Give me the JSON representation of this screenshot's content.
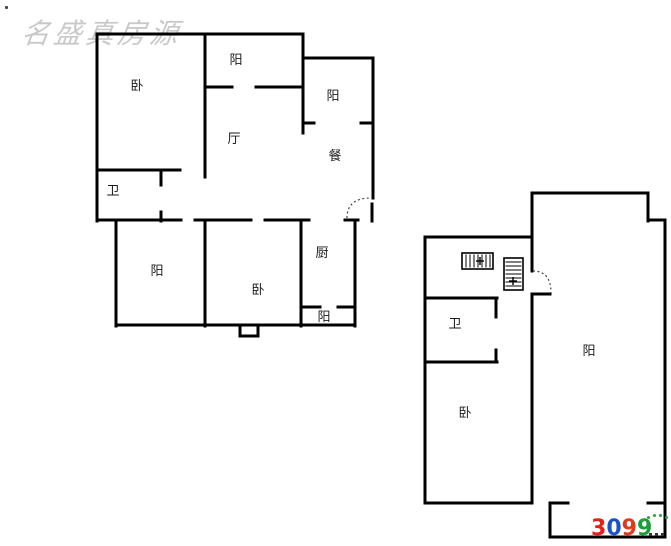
{
  "watermark": {
    "text": "名盛真房源",
    "color": "#c9c9c9"
  },
  "logo": {
    "digits": [
      {
        "char": "3",
        "color": "#e02316"
      },
      {
        "char": "0",
        "color": "#1c52c8"
      },
      {
        "char": "9",
        "color": "#e0391c"
      },
      {
        "char": "9",
        "color": "#1a9e36"
      }
    ],
    "arc_color": "#2f9e44",
    "arc_dot_count": 5,
    "tail_color": "#333333",
    "tail_mark_count": 3
  },
  "floorplans": [
    {
      "id": "unit-a",
      "walls": [
        [
          97,
          34,
          303,
          34
        ],
        [
          97,
          34,
          97,
          221
        ],
        [
          205,
          34,
          205,
          177
        ],
        [
          303,
          34,
          303,
          133
        ],
        [
          303,
          58,
          373,
          58
        ],
        [
          373,
          58,
          373,
          198
        ],
        [
          372,
          204,
          372,
          221
        ],
        [
          303,
          123,
          314,
          123
        ],
        [
          361,
          123,
          373,
          123
        ],
        [
          205,
          87,
          232,
          87
        ],
        [
          256,
          87,
          303,
          87
        ],
        [
          97,
          170,
          180,
          170
        ],
        [
          161,
          170,
          161,
          185
        ],
        [
          161,
          212,
          161,
          221
        ],
        [
          97,
          220,
          181,
          220
        ],
        [
          195,
          220,
          251,
          220
        ],
        [
          265,
          220,
          309,
          220
        ],
        [
          345,
          220,
          358,
          220
        ],
        [
          116,
          220,
          116,
          326
        ],
        [
          205,
          220,
          205,
          326
        ],
        [
          301,
          220,
          301,
          326
        ],
        [
          355,
          220,
          355,
          326
        ],
        [
          116,
          325,
          355,
          325
        ],
        [
          240,
          325,
          240,
          336
        ],
        [
          240,
          336,
          258,
          336
        ],
        [
          258,
          325,
          258,
          336
        ],
        [
          301,
          307,
          320,
          307
        ],
        [
          338,
          307,
          355,
          307
        ]
      ],
      "door_arcs": [
        {
          "d": "M347,218 Q347,198 371,198"
        }
      ],
      "window_symbols": [],
      "labels": [
        {
          "text": "卧",
          "x": 137,
          "y": 86
        },
        {
          "text": "阳",
          "x": 236,
          "y": 60
        },
        {
          "text": "阳",
          "x": 333,
          "y": 96
        },
        {
          "text": "厅",
          "x": 234,
          "y": 139
        },
        {
          "text": "餐",
          "x": 335,
          "y": 156
        },
        {
          "text": "卫",
          "x": 113,
          "y": 191
        },
        {
          "text": "阳",
          "x": 157,
          "y": 271
        },
        {
          "text": "卧",
          "x": 258,
          "y": 290
        },
        {
          "text": "厨",
          "x": 322,
          "y": 253
        },
        {
          "text": "阳",
          "x": 324,
          "y": 317
        }
      ]
    },
    {
      "id": "unit-b",
      "walls": [
        [
          425,
          237,
          532,
          237
        ],
        [
          425,
          237,
          425,
          503
        ],
        [
          425,
          298,
          497,
          298
        ],
        [
          496,
          298,
          496,
          317
        ],
        [
          425,
          362,
          497,
          362
        ],
        [
          496,
          350,
          496,
          362
        ],
        [
          425,
          503,
          532,
          503
        ],
        [
          532,
          193,
          532,
          271
        ],
        [
          532,
          295,
          532,
          503
        ],
        [
          532,
          294,
          550,
          294
        ],
        [
          532,
          193,
          648,
          193
        ],
        [
          648,
          193,
          648,
          221
        ],
        [
          648,
          220,
          665,
          220
        ],
        [
          665,
          220,
          665,
          537
        ],
        [
          648,
          503,
          665,
          503
        ],
        [
          550,
          503,
          568,
          503
        ],
        [
          550,
          503,
          550,
          537
        ],
        [
          550,
          537,
          665,
          537
        ]
      ],
      "door_arcs": [
        {
          "d": "M533,271 Q551,271 551,293"
        }
      ],
      "window_symbols": [
        {
          "x": 462,
          "y": 253,
          "w": 31,
          "h": 16,
          "hatch": "vertical",
          "cross": {
            "x": 480,
            "y": 261
          }
        },
        {
          "x": 504,
          "y": 258,
          "w": 19,
          "h": 32,
          "hatch": "horizontal",
          "cross": {
            "x": 513,
            "y": 281
          }
        }
      ],
      "labels": [
        {
          "text": "卫",
          "x": 455,
          "y": 324
        },
        {
          "text": "卧",
          "x": 465,
          "y": 413
        },
        {
          "text": "阳",
          "x": 589,
          "y": 351
        }
      ]
    }
  ]
}
